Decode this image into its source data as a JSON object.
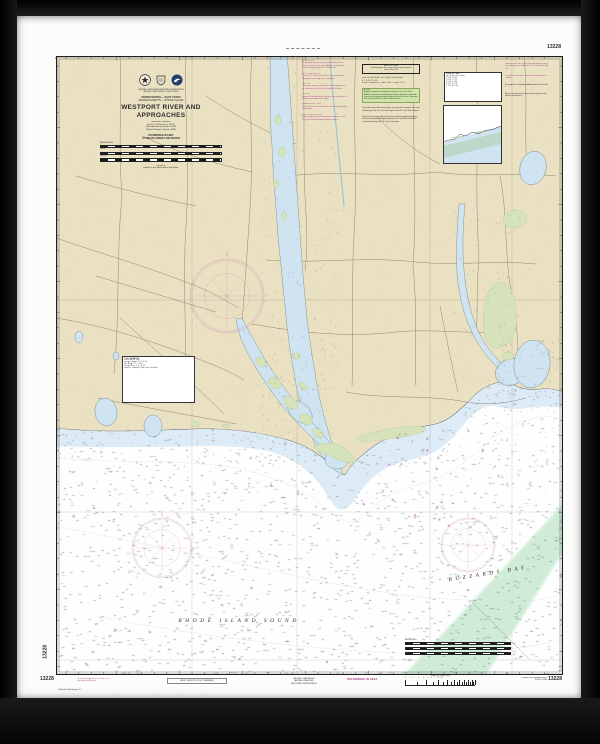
{
  "chart": {
    "number": "13228"
  },
  "margins": {
    "soundings_top": "SOUNDINGS IN FEET",
    "number_top_right": "13228",
    "number_left_vertical": "13228",
    "bottom": {
      "number_left": "13228",
      "corrections": "Corrected through NM 12/13  LNM 11/13\n(see Notice to Mariners)",
      "boxed_note": "VERIFY LATEST NOTICE TO MARINERS",
      "published": "Published at Washington, D.C.",
      "long_note": "Chart produced from official U.S. Government sources. The prudent mariner will use the largest scale chart available and keep it corrected from the latest Notice to Mariners.",
      "agency": "PUBLISHED BY THE\nNATIONAL OCEAN SERVICE\nNATIONAL OCEANIC AND\nATMOSPHERIC ADMINISTRATION",
      "soundings": "SOUNDINGS IN FEET",
      "log_scale_label": "LOGARITHMIC SPEED SCALE",
      "log_scale_numbers": "1        2      3     4    5   6   7  8  9 10",
      "right_title": "Westport River and Approaches\nScale 1:20,000",
      "number_right": "13228"
    }
  },
  "title_block": {
    "department": "U.S. DEPARTMENT OF COMMERCE\nNATIONAL OCEANIC AND ATMOSPHERIC ADMINISTRATION\nNATIONAL OCEAN SERVICE  •  COAST SURVEY",
    "region": "UNITED STATES — EAST COAST",
    "states": "MASSACHUSETTS — RHODE ISLAND",
    "title": "WESTPORT RIVER AND APPROACHES",
    "projection": "Mercator Projection\nScale 1:20,000 at Lat. 41°31'\nNorth American Datum of 1983\n(World Geodetic System 1984)",
    "soundings": "SOUNDINGS IN FEET\nAT MEAN LOWER LOW WATER",
    "scale_labels": {
      "nm": "NAUTICAL MILES",
      "yards": "YARDS",
      "meters": "METERS"
    },
    "heights_note": "HEIGHTS\nHeights in feet above Mean High Water"
  },
  "sea_labels": {
    "rhode_island_sound": "RHODE ISLAND SOUND",
    "buzzards_bay": "BUZZARDS BAY"
  },
  "notes": {
    "left": [
      "AUTHORITIES\nHydrography and topography by the National Ocean Service, Coast Survey, with additional surveys by the Corps of Engineers and U.S. Coast Guard.",
      "AIDS TO NAVIGATION\nConsult U.S. Coast Guard Light List for supplemental information concerning aids to navigation.",
      "CAUTION\nTemporary changes or defects in aids to navigation are not indicated on this chart. See Notice to Mariners.",
      "CAUTION\nImproved channels shown by broken lines are subject to shoaling, particularly at the edges.",
      "RADAR REFLECTORS\nRadar reflectors have been placed on many floating aids to navigation.",
      "POLLUTION REPORTS\nReport all spills of oil and hazardous substances to the U.S. Coast Guard National Response Center."
    ],
    "center": {
      "survey_table": "WESTPORT RIVER\nControlling depths from surveys of the Corps of Engineers\nreport of June 1995",
      "depth_rows": "CONTROLLING DEPTHS IN FEET FROM SEAWARD\nLeft outside   Middle half   Right outside   Date\n     6.1            8.4            5.9        6-95\nProject dimensions:  width 100 ft,  depth 10 ft",
      "green_note": "NOTE A\nNavigation regulations are published in Chapter 2, U.S. Coast Pilot 2. Additions or revisions are published in the Notices to Mariners. Information concerning the regulations may be obtained at the Office of the Commander, First Coast Guard District in Boston, Massachusetts.",
      "caution": "CAUTION\nThe prudent mariner will not rely solely on any single aid to navigation, particularly on floating aids. See U.S. Coast Guard Light List and U.S. Coast Pilot for details.",
      "note": "NOTE\nThis chart has been corrected from the Notice to Mariners published weekly by the National Geospatial-Intelligence Agency and the Local Notice to Mariners issued periodically by each U.S. Coast Guard district."
    },
    "right": [
      "CAUTION\nLimitations on the use of certain other radio signals as aids to marine navigation can be found in the U.S. Coast Guard Light Lists.",
      "WARNING\nThe prudent mariner will not rely solely on any single aid to navigation.",
      "ABBREVIATIONS\nFor complete list of Symbols and Abbreviations see Chart No. 1",
      "REPORTS\nMariners are requested to report chart discrepancies to the National Ocean Service."
    ]
  },
  "tables": {
    "conversion": "CONVERSION TABLE\nFeet  Meters      Feet  Meters\n  1    0.30         6    1.83\n  2    0.61         7    2.13\n  3    0.91         8    2.44\n  4    1.22         9    2.74\n  5    1.52        10    3.05",
    "tidal": "TIDAL INFORMATION\nPlace             MHW  MTL  MLLW\nWestport Harbor   3.0  1.5   0.0\nHix Bridge        2.7  1.4   0.0\nSlocums River     3.4  1.7   0.0\nDatum of soundings: Mean Lower Low Water"
  }
}
